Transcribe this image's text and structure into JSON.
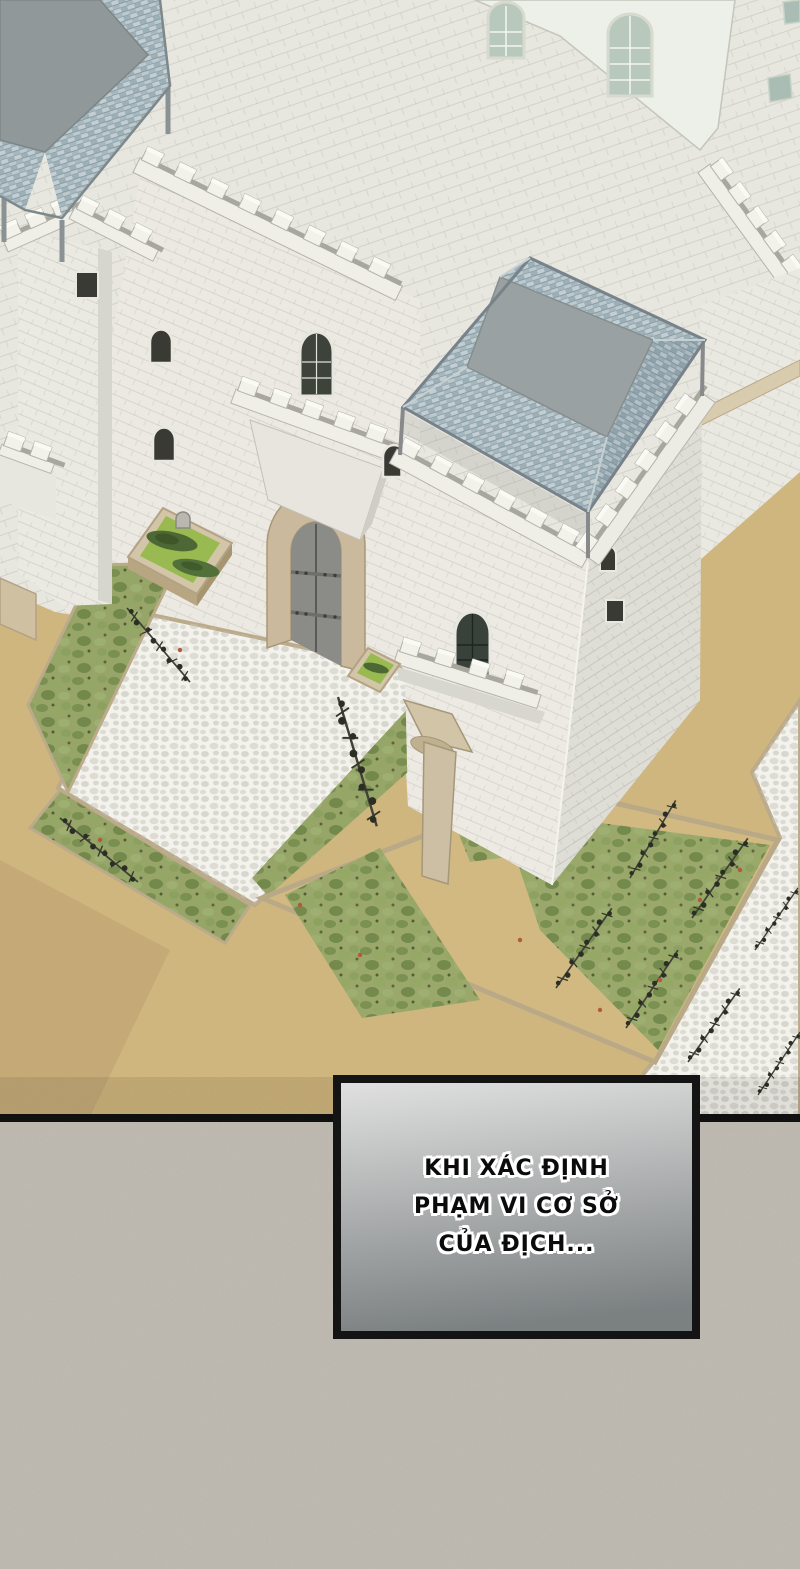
{
  "dialogue": {
    "lines": [
      "KHI XÁC ĐỊNH",
      "PHẠM VI CƠ SỞ",
      "CỦA ĐỊCH..."
    ],
    "text_color": "#0b0b0b",
    "outline_color": "#ffffff",
    "box_border_color": "#141414",
    "box_gradient_top": "#e0e0e0",
    "box_gradient_bottom": "#7b8081"
  },
  "colors": {
    "ink": "#121212",
    "panel_background": "#cdc8bf",
    "wall_light": "#ebe9e2",
    "wall_top_plane": "#e7e6df",
    "wall_shadow": "#deddd6",
    "parapet": "#f2f1ea",
    "background_building": "#edf0e9",
    "window_glass": "#b9c8bd",
    "window_dark": "#3a3a34",
    "roof_tile": "#b3c2c8",
    "roof_top": "#9aa1a2",
    "gate_frame": "#cbb99e",
    "gate_door": "#8b8b87",
    "sand": "#cfb57e",
    "dirt_shadow": "#b89d70",
    "path": "#f3f2ed",
    "curb": "#bcab8a",
    "lawn": "#98ba50",
    "bush": "#4d6834",
    "shrub": "#97a569",
    "vine": "#3a3c31",
    "flower": "#b35a3a",
    "banner": "#cdbfa3"
  }
}
